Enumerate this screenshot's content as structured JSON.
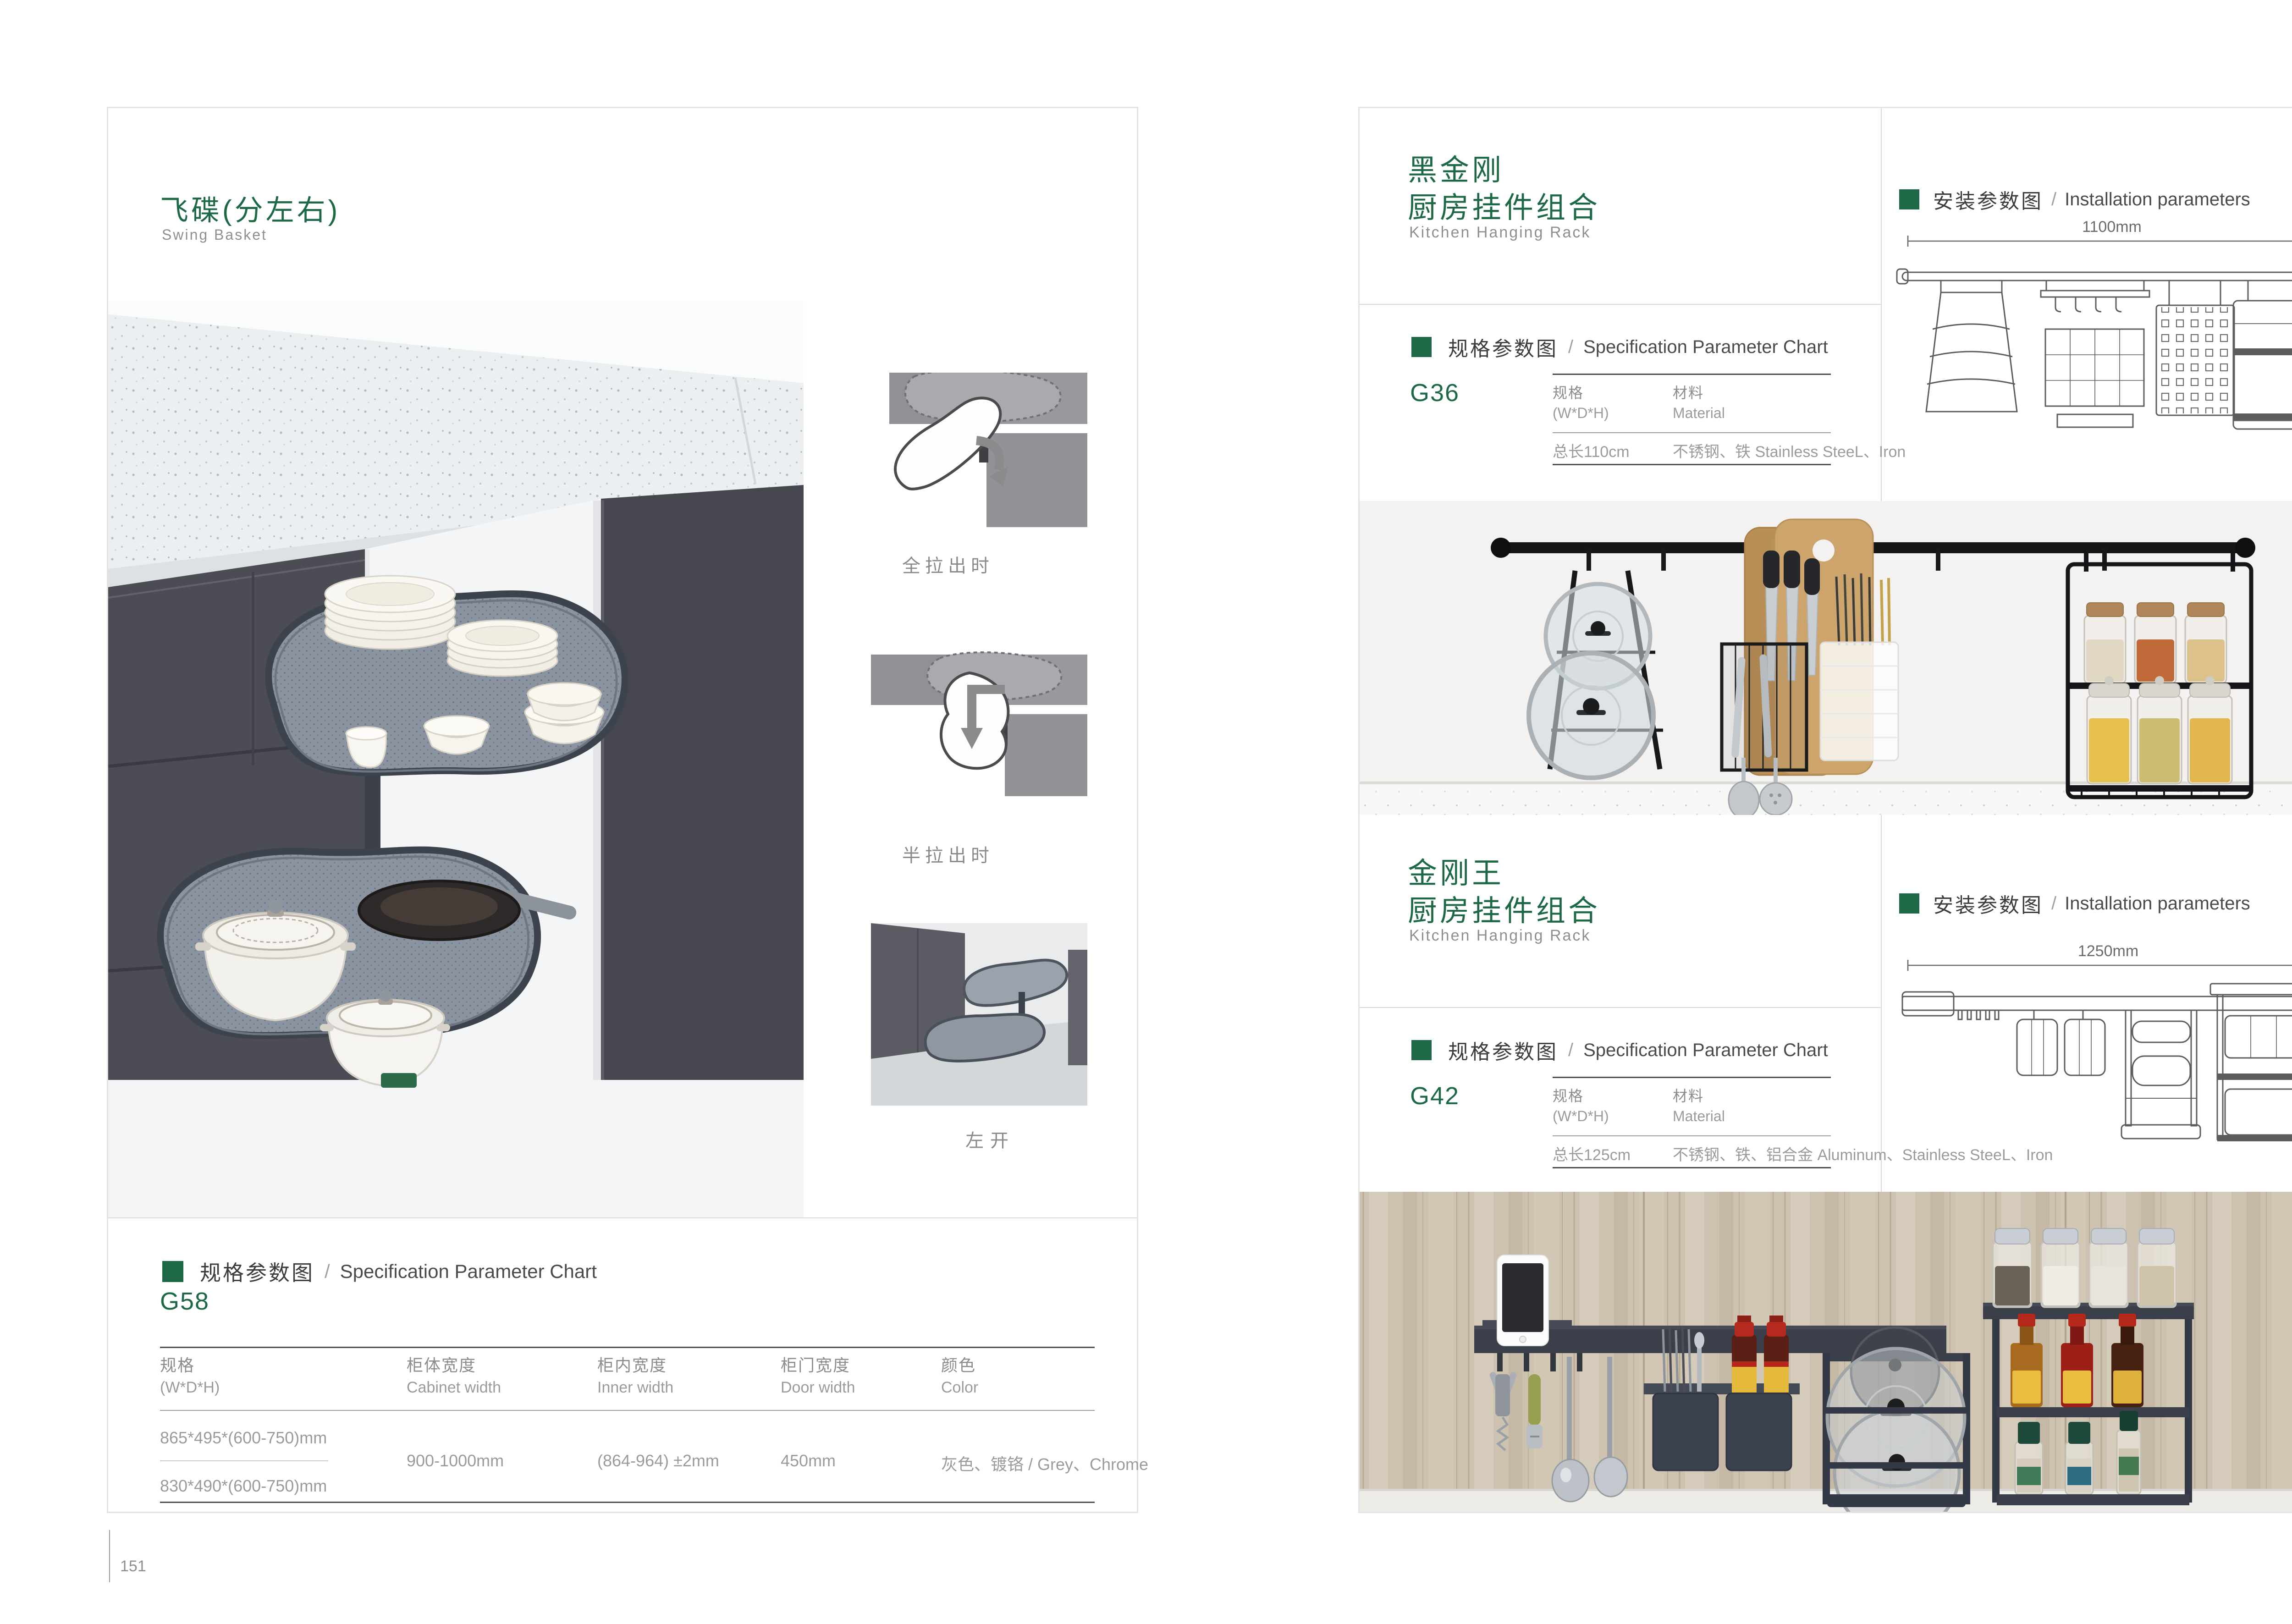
{
  "left_page": {
    "title_cn": "飞碟(分左右)",
    "title_en": "Swing Basket",
    "thumb_captions": [
      "全拉出时",
      "半拉出时",
      "左开"
    ],
    "spec_heading_cn": "规格参数图",
    "spec_heading_sep": "/",
    "spec_heading_en": "Specification Parameter Chart",
    "model": "G58",
    "table": {
      "col1_cn": "规格",
      "col1_en": "(W*D*H)",
      "col2_cn": "柜体宽度",
      "col2_en": "Cabinet width",
      "col3_cn": "柜内宽度",
      "col3_en": "Inner width",
      "col4_cn": "柜门宽度",
      "col4_en": "Door width",
      "col5_cn": "颜色",
      "col5_en": "Color",
      "size1": "865*495*(600-750)mm",
      "size2": "830*490*(600-750)mm",
      "cabinet_width": "900-1000mm",
      "inner_width": "(864-964) ±2mm",
      "door_width": "450mm",
      "color": "灰色、镀铬 / Grey、Chrome"
    },
    "page_number": "151"
  },
  "right_page": {
    "install_heading_cn": "安装参数图",
    "install_heading_sep": "/",
    "install_heading_en": "Installation parameters",
    "spec_heading_cn": "规格参数图",
    "spec_heading_sep": "/",
    "spec_heading_en": "Specification Parameter Chart",
    "col_spec_cn": "规格",
    "col_spec_en": "(W*D*H)",
    "col_mat_cn": "材料",
    "col_mat_en": "Material",
    "sections": [
      {
        "title_cn_1": "黑金刚",
        "title_cn_2": "厨房挂件组合",
        "title_en": "Kitchen Hanging Rack",
        "model": "G36",
        "spec_value": "总长110cm",
        "material": "不锈钢、铁  Stainless SteeL、Iron",
        "dim_w": "1100mm",
        "dim_h": "420mm"
      },
      {
        "title_cn_1": "金刚王",
        "title_cn_2": "厨房挂件组合",
        "title_en": "Kitchen Hanging Rack",
        "model": "G42",
        "spec_value": "总长125cm",
        "material": "不锈钢、铁、铝合金  Aluminum、Stainless SteeL、Iron",
        "dim_w": "1250mm",
        "dim_h": "430mm"
      }
    ],
    "page_number": "152"
  }
}
